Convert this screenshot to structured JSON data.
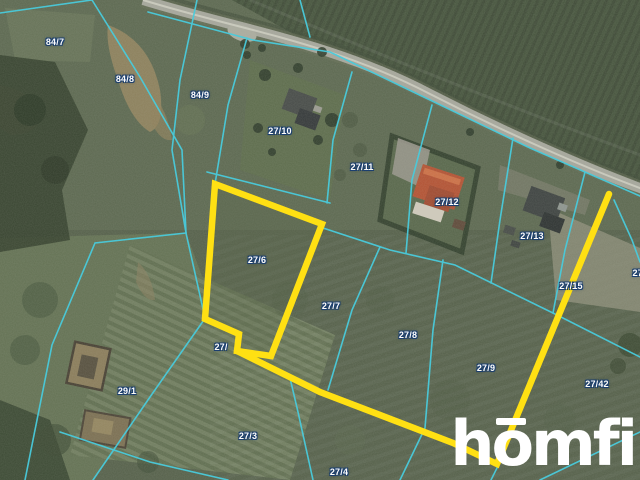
{
  "map": {
    "description": "Aerial cadastral map with parcel boundaries and highlighted plot",
    "boundary_color": "#49cbdc",
    "highlight_color": "#ffe013",
    "highlighted_parcel": "27/6",
    "parcel_labels": [
      {
        "text": "84/7",
        "x": 55,
        "y": 42
      },
      {
        "text": "84/8",
        "x": 125,
        "y": 79
      },
      {
        "text": "84/9",
        "x": 200,
        "y": 95
      },
      {
        "text": "27/10",
        "x": 280,
        "y": 131
      },
      {
        "text": "27/11",
        "x": 362,
        "y": 167
      },
      {
        "text": "27/12",
        "x": 447,
        "y": 202
      },
      {
        "text": "27/13",
        "x": 532,
        "y": 236
      },
      {
        "text": "27/6",
        "x": 257,
        "y": 260
      },
      {
        "text": "27/7",
        "x": 331,
        "y": 306
      },
      {
        "text": "27/8",
        "x": 408,
        "y": 335
      },
      {
        "text": "27/9",
        "x": 486,
        "y": 368
      },
      {
        "text": "27/15",
        "x": 571,
        "y": 286
      },
      {
        "text": "27/",
        "x": 639,
        "y": 273
      },
      {
        "text": "27/42",
        "x": 597,
        "y": 384
      },
      {
        "text": "29/1",
        "x": 127,
        "y": 391
      },
      {
        "text": "27/",
        "x": 221,
        "y": 347
      },
      {
        "text": "27/3",
        "x": 248,
        "y": 436
      },
      {
        "text": "27/4",
        "x": 339,
        "y": 472
      }
    ],
    "highlight_geometry": {
      "parcel_outline": [
        [
          215,
          184
        ],
        [
          322,
          224
        ],
        [
          271,
          356
        ],
        [
          237,
          351
        ],
        [
          239,
          334
        ],
        [
          205,
          319
        ]
      ],
      "route_line": [
        [
          237,
          351
        ],
        [
          320,
          392
        ],
        [
          453,
          443
        ],
        [
          497,
          464
        ],
        [
          609,
          194
        ]
      ]
    }
  },
  "logo": {
    "brand": "homfi",
    "color": "#ffffff"
  }
}
